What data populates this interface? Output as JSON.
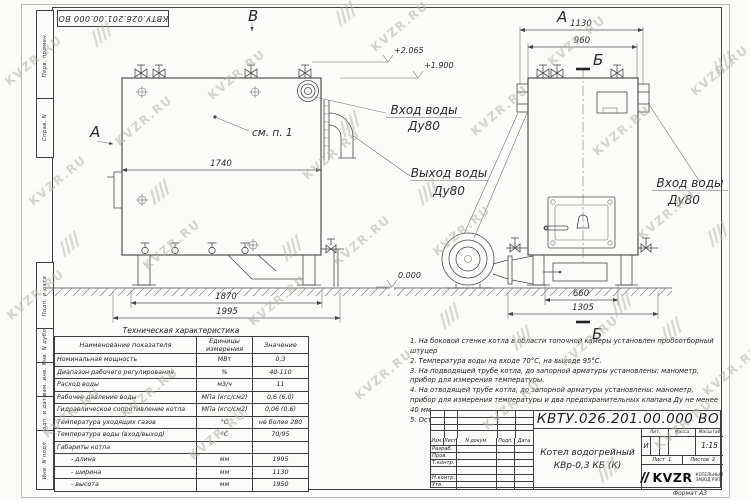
{
  "watermark": {
    "text": "KVZR.RU"
  },
  "frame": {
    "doc_box": "КВТУ.026.201.00.000 ВО",
    "side_labels": [
      "Перв. примен.",
      "Справ. N",
      "Подп. и дата",
      "Инв. N дубл.",
      "Взам. инв. N",
      "Подп. и дата",
      "Инв. N подл."
    ],
    "format_note": "Формат  А3"
  },
  "views": {
    "marker_a": "А",
    "marker_b": "В",
    "section_label": "Б",
    "see_note": "см. п. 1",
    "inlet_label": "Вход воды",
    "inlet_dn": "Ду80",
    "outlet_label": "Выход воды",
    "outlet_dn": "Ду80",
    "dims": {
      "front_top": "1740",
      "front_base": "1870",
      "front_overall": "1995",
      "side_top": "1130",
      "side_inner": "960",
      "side_base_inner": "660",
      "side_base": "1305"
    },
    "elevations": {
      "valves": "+2.065",
      "body_top": "+1.900",
      "ground": "0.000"
    }
  },
  "spec_table": {
    "title": "Техническая характеристика",
    "headers": [
      "Наименование показателя",
      "Единицы измерения",
      "Значение"
    ],
    "rows": [
      [
        "Номинальная мощность",
        "МВт",
        "0,3"
      ],
      [
        "Диапазон рабочего регулирования",
        "%",
        "40-110"
      ],
      [
        "Расход воды",
        "м3/ч",
        "11"
      ],
      [
        "Рабочее давление воды",
        "МПа (кгс/см2)",
        "0,6 (6,0)"
      ],
      [
        "Гидравлическое сопротивление котла",
        "МПа (кгс/см2)",
        "0,06 (0,6)"
      ],
      [
        "Температура уходящих газов",
        "°С",
        "не более 280"
      ],
      [
        "Температура воды (вход/выход)",
        "°С",
        "70/95"
      ],
      [
        "Габариты котла",
        "",
        ""
      ],
      [
        "- длина",
        "мм",
        "1995"
      ],
      [
        "- ширина",
        "мм",
        "1130"
      ],
      [
        "- высота",
        "мм",
        "1950"
      ]
    ]
  },
  "notes": {
    "items": [
      "1. На боковой стенке котла в области топочной камеры установлен пробоотборный штуцер",
      "2. Температура воды на входе 70°С, на выходе 95°С.",
      "3. На подводящей трубе котла, до запорной арматуры установлены: манометр, прибор для измерения температуры.",
      "4. На отводящей трубе котла, до запорной арматуры установлены: манометр, прибор для измерения температуры и два предохранительных клапана Ду не менее 40 мм.",
      "5. Остальные технические требования по ОСТ 108.030.133-84."
    ]
  },
  "title_block": {
    "number": "КВТУ.026.201.00.000  ВО",
    "product_line1": "Котел водогрейный",
    "product_line2": "КВр-0,3 КБ (К)",
    "cols": [
      "Изм.",
      "Лист",
      "N докум.",
      "Подп.",
      "Дата"
    ],
    "row_labels": [
      "Разраб.",
      "Пров.",
      "Т.контр.",
      "",
      "Н.контр.",
      "Утв."
    ],
    "lit_label": "Лит.",
    "mass_label": "Масса",
    "scale_label": "Масштаб",
    "lit_value": "И",
    "scale_value": "1:15",
    "sheet_label": "Лист",
    "sheet_value": "1",
    "sheets_label": "Листов",
    "sheets_value": "2",
    "company": "KVZR",
    "company_sub1": "КОТЕЛЬНЫЙ",
    "company_sub2": "ЗАВОД РЭП"
  }
}
